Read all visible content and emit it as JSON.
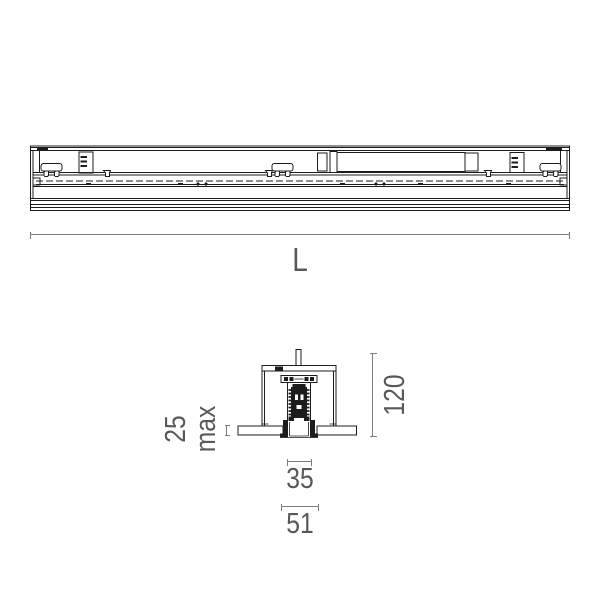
{
  "colors": {
    "drawing_line": "#1c1c1c",
    "dimension_line": "#7d7d7d",
    "dimension_text": "#58585a",
    "background": "#ffffff"
  },
  "dimensions": {
    "length": {
      "label": "L"
    },
    "ceiling_thickness": {
      "value": "25",
      "qualifier": "max"
    },
    "overall_height": {
      "value": "120"
    },
    "aperture_width": {
      "value": "35"
    },
    "trim_width": {
      "value": "51"
    }
  }
}
